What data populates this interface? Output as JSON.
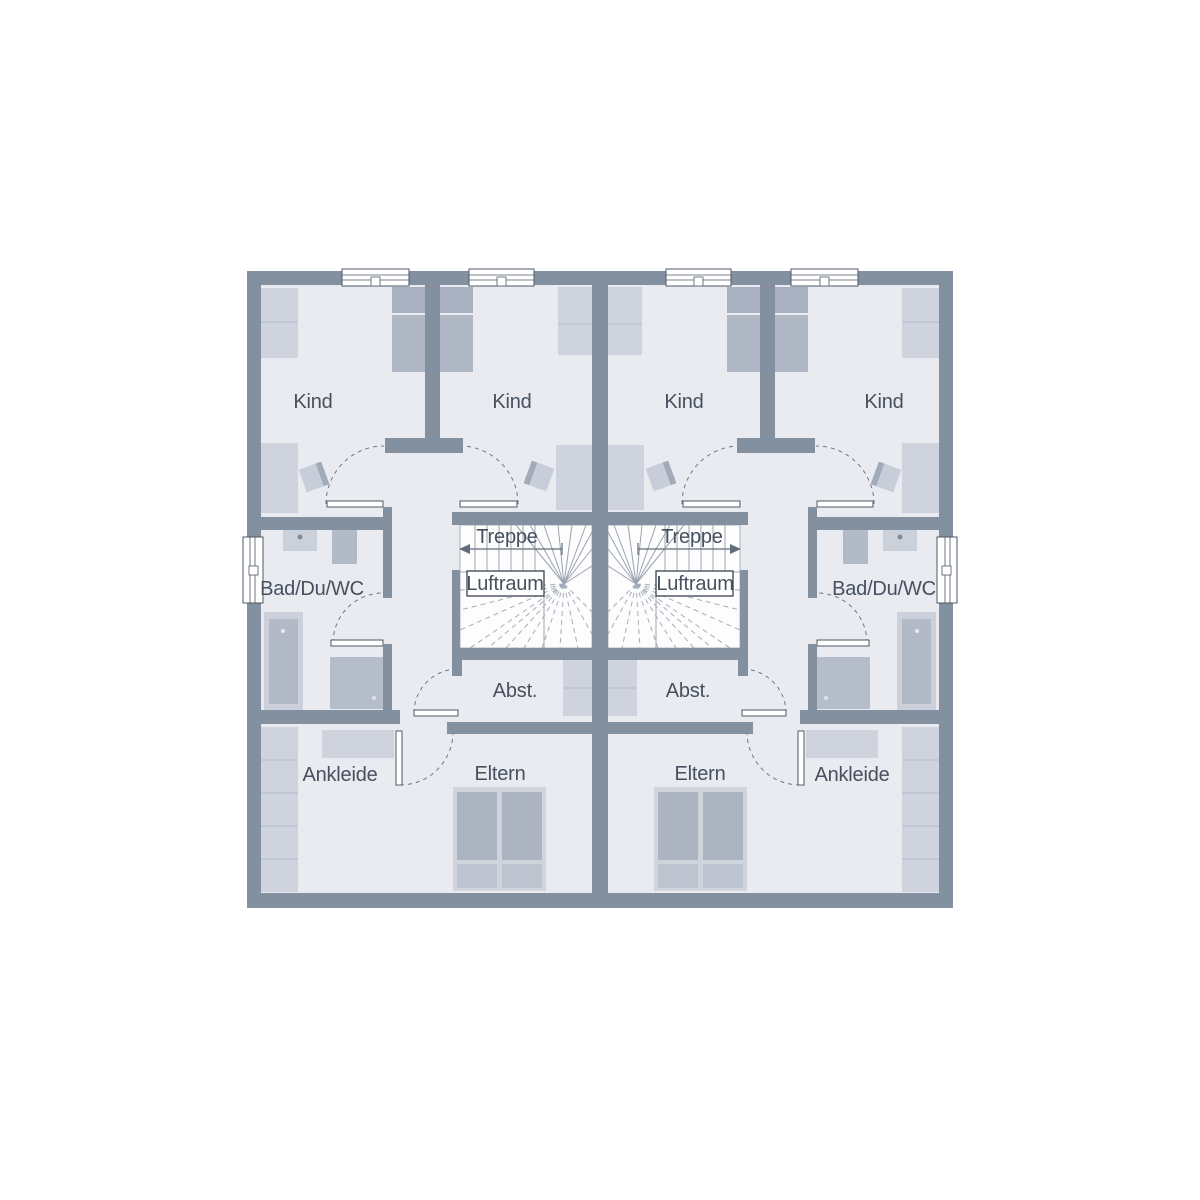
{
  "floor_plan": {
    "labels": {
      "kind": "Kind",
      "bad_du_wc": "Bad/Du/WC",
      "treppe": "Treppe",
      "luftraum": "Luftraum",
      "abst": "Abst.",
      "ankleide": "Ankleide",
      "eltern": "Eltern"
    },
    "units": [
      {
        "name": "left",
        "rooms": [
          "Kind",
          "Kind",
          "Bad/Du/WC",
          "Treppe",
          "Luftraum",
          "Abst.",
          "Ankleide",
          "Eltern"
        ]
      },
      {
        "name": "right",
        "rooms": [
          "Kind",
          "Kind",
          "Bad/Du/WC",
          "Treppe",
          "Luftraum",
          "Abst.",
          "Ankleide",
          "Eltern"
        ]
      }
    ],
    "colors": {
      "wall": "#8290A0",
      "floor": "#E9EBF0",
      "furniture_light": "#CED3DD",
      "furniture_medium": "#B2B9C7",
      "furniture_dark": "#A9B0BF",
      "pillow": "#BEC4CF",
      "stair_line": "#9AA3B0",
      "text": "#46505E",
      "background": "#FFFFFF"
    }
  }
}
